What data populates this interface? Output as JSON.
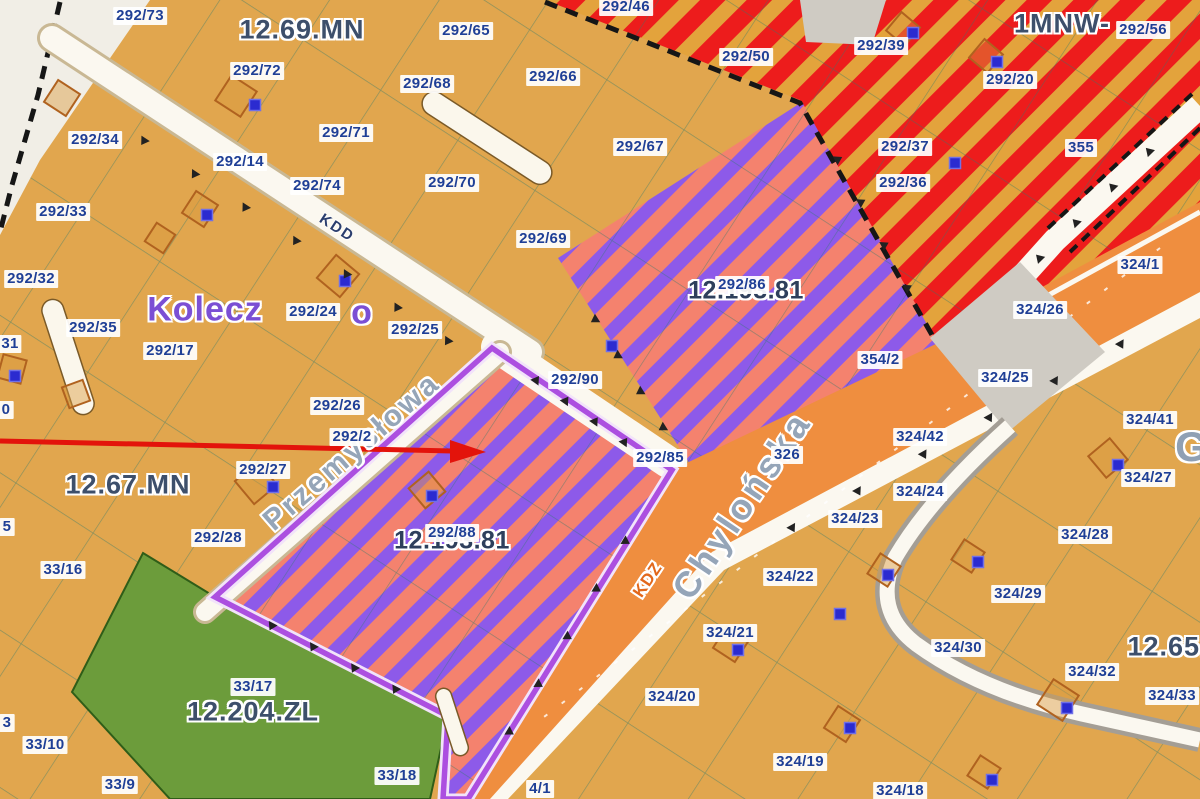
{
  "map": {
    "colors": {
      "background_mn": "#E1A64E",
      "hatch_salmon": "#F4826E",
      "hatch_violet": "#8D5AE9",
      "hatch_gold": "#E3A33C",
      "hatch_red": "#ED1C1C",
      "forest_green": "#6C9C3B",
      "road_orange": "#EF8E3F",
      "road_white": "#FBF8F0",
      "gray_area": "#CFCBC3",
      "parcel_label_text": "#1F3F96",
      "zone_label_text": "#3D4F6B",
      "selection_outline": "#AC4FE0",
      "arrow_red": "#E3130B",
      "plan_boundary": "#161616",
      "cadastre_line": "#2F7A6B"
    },
    "zone_area_labels": [
      {
        "text": "12.69.MN",
        "x": 302,
        "y": 30,
        "kind": "big"
      },
      {
        "text": "1MNW-",
        "x": 1062,
        "y": 24,
        "kind": "big"
      },
      {
        "text": "12.67.MN",
        "x": 128,
        "y": 485,
        "kind": "big"
      },
      {
        "text": "12.204.ZL",
        "x": 253,
        "y": 712,
        "kind": "big"
      },
      {
        "text": "12.65.",
        "x": 1168,
        "y": 647,
        "kind": "big"
      },
      {
        "text": "12.193.81",
        "x": 746,
        "y": 291,
        "kind": "code"
      },
      {
        "text": "12.193.81",
        "x": 452,
        "y": 541,
        "kind": "code"
      },
      {
        "text": "Kolecz",
        "x": 205,
        "y": 310,
        "kind": "purple"
      },
      {
        "text": "o",
        "x": 362,
        "y": 313,
        "kind": "purple"
      },
      {
        "text": "G",
        "x": 1192,
        "y": 447,
        "kind": "gray"
      }
    ],
    "parcel_labels": [
      {
        "text": "292/73",
        "x": 140,
        "y": 16
      },
      {
        "text": "292/65",
        "x": 466,
        "y": 31
      },
      {
        "text": "292/46",
        "x": 626,
        "y": 7
      },
      {
        "text": "292/50",
        "x": 746,
        "y": 57
      },
      {
        "text": "292/39",
        "x": 881,
        "y": 46
      },
      {
        "text": "292/56",
        "x": 1143,
        "y": 30
      },
      {
        "text": "292/72",
        "x": 257,
        "y": 71
      },
      {
        "text": "292/68",
        "x": 427,
        "y": 84
      },
      {
        "text": "292/66",
        "x": 553,
        "y": 77
      },
      {
        "text": "292/20",
        "x": 1010,
        "y": 80
      },
      {
        "text": "292/34",
        "x": 95,
        "y": 140
      },
      {
        "text": "292/71",
        "x": 346,
        "y": 133
      },
      {
        "text": "292/14",
        "x": 240,
        "y": 162
      },
      {
        "text": "292/74",
        "x": 317,
        "y": 186
      },
      {
        "text": "292/70",
        "x": 452,
        "y": 183
      },
      {
        "text": "292/67",
        "x": 640,
        "y": 147
      },
      {
        "text": "292/37",
        "x": 905,
        "y": 147
      },
      {
        "text": "292/36",
        "x": 903,
        "y": 183
      },
      {
        "text": "355",
        "x": 1081,
        "y": 148
      },
      {
        "text": "292/33",
        "x": 63,
        "y": 212
      },
      {
        "text": "292/69",
        "x": 543,
        "y": 239
      },
      {
        "text": "292/32",
        "x": 31,
        "y": 279
      },
      {
        "text": "292/35",
        "x": 93,
        "y": 328
      },
      {
        "text": "292/17",
        "x": 170,
        "y": 351
      },
      {
        "text": "292/24",
        "x": 313,
        "y": 312
      },
      {
        "text": "324/1",
        "x": 1140,
        "y": 265
      },
      {
        "text": "292/25",
        "x": 415,
        "y": 330
      },
      {
        "text": "324/26",
        "x": 1040,
        "y": 310
      },
      {
        "text": "292/26",
        "x": 337,
        "y": 406
      },
      {
        "text": "292/90",
        "x": 575,
        "y": 380
      },
      {
        "text": "354/2",
        "x": 880,
        "y": 360
      },
      {
        "text": "324/25",
        "x": 1005,
        "y": 378
      },
      {
        "text": "31",
        "x": 10,
        "y": 344
      },
      {
        "text": "0",
        "x": 6,
        "y": 410
      },
      {
        "text": "5",
        "x": 7,
        "y": 527
      },
      {
        "text": "3",
        "x": 7,
        "y": 723
      },
      {
        "text": "292/27",
        "x": 263,
        "y": 470
      },
      {
        "text": "292/2",
        "x": 352,
        "y": 437
      },
      {
        "text": "292/28",
        "x": 218,
        "y": 538
      },
      {
        "text": "292/85",
        "x": 660,
        "y": 458
      },
      {
        "text": "326",
        "x": 787,
        "y": 455
      },
      {
        "text": "324/42",
        "x": 920,
        "y": 437
      },
      {
        "text": "324/24",
        "x": 920,
        "y": 492
      },
      {
        "text": "324/41",
        "x": 1150,
        "y": 420
      },
      {
        "text": "324/23",
        "x": 855,
        "y": 519
      },
      {
        "text": "324/27",
        "x": 1148,
        "y": 478
      },
      {
        "text": "324/28",
        "x": 1085,
        "y": 535
      },
      {
        "text": "324/22",
        "x": 790,
        "y": 577
      },
      {
        "text": "324/21",
        "x": 730,
        "y": 633
      },
      {
        "text": "324/29",
        "x": 1018,
        "y": 594
      },
      {
        "text": "324/30",
        "x": 958,
        "y": 648
      },
      {
        "text": "324/32",
        "x": 1092,
        "y": 672
      },
      {
        "text": "324/33",
        "x": 1172,
        "y": 696
      },
      {
        "text": "324/20",
        "x": 672,
        "y": 697
      },
      {
        "text": "33/17",
        "x": 253,
        "y": 687
      },
      {
        "text": "33/16",
        "x": 63,
        "y": 570
      },
      {
        "text": "33/10",
        "x": 45,
        "y": 745
      },
      {
        "text": "33/9",
        "x": 120,
        "y": 785
      },
      {
        "text": "33/18",
        "x": 397,
        "y": 776
      },
      {
        "text": "324/19",
        "x": 800,
        "y": 762
      },
      {
        "text": "324/18",
        "x": 900,
        "y": 791
      },
      {
        "text": "4/1",
        "x": 540,
        "y": 789
      },
      {
        "text": "292/86",
        "x": 742,
        "y": 285
      },
      {
        "text": "292/88",
        "x": 452,
        "y": 533
      }
    ],
    "street_labels": [
      {
        "text": "Chylońska",
        "x": 742,
        "y": 505,
        "rot": -56,
        "kind": "name-large"
      },
      {
        "text": "Przemysłowa",
        "x": 352,
        "y": 452,
        "rot": -41,
        "kind": "name-med"
      },
      {
        "text": "KDZ",
        "x": 648,
        "y": 580,
        "rot": -56,
        "kind": "kdz"
      },
      {
        "text": "KDD",
        "x": 337,
        "y": 228,
        "rot": 33,
        "kind": "kdd"
      }
    ],
    "building_points": [
      [
        255,
        105
      ],
      [
        207,
        215
      ],
      [
        913,
        33
      ],
      [
        997,
        62
      ],
      [
        955,
        163
      ],
      [
        345,
        281
      ],
      [
        15,
        376
      ],
      [
        273,
        487
      ],
      [
        612,
        346
      ],
      [
        432,
        496
      ],
      [
        738,
        650
      ],
      [
        978,
        562
      ],
      [
        888,
        575
      ],
      [
        840,
        614
      ],
      [
        850,
        728
      ],
      [
        1067,
        708
      ],
      [
        992,
        780
      ],
      [
        1118,
        465
      ]
    ],
    "building_outlines": [
      [
        236,
        96,
        30,
        33
      ],
      [
        200,
        209,
        26,
        33
      ],
      [
        903,
        29,
        24,
        40
      ],
      [
        986,
        56,
        24,
        40
      ],
      [
        338,
        276,
        30,
        40
      ],
      [
        12,
        369,
        24,
        15
      ],
      [
        256,
        483,
        30,
        -40
      ],
      [
        427,
        490,
        26,
        -40
      ],
      [
        731,
        644,
        26,
        33
      ],
      [
        968,
        556,
        24,
        33
      ],
      [
        842,
        724,
        26,
        33
      ],
      [
        1058,
        700,
        30,
        33
      ],
      [
        1108,
        458,
        28,
        -40
      ],
      [
        884,
        570,
        24,
        33
      ],
      [
        984,
        772,
        24,
        33
      ],
      [
        76,
        394,
        22,
        70
      ],
      [
        160,
        238,
        22,
        33
      ],
      [
        62,
        98,
        26,
        33
      ]
    ],
    "annotation": {
      "type": "arrow",
      "color": "#E3130B",
      "points_to": "parcel 292/88"
    }
  }
}
